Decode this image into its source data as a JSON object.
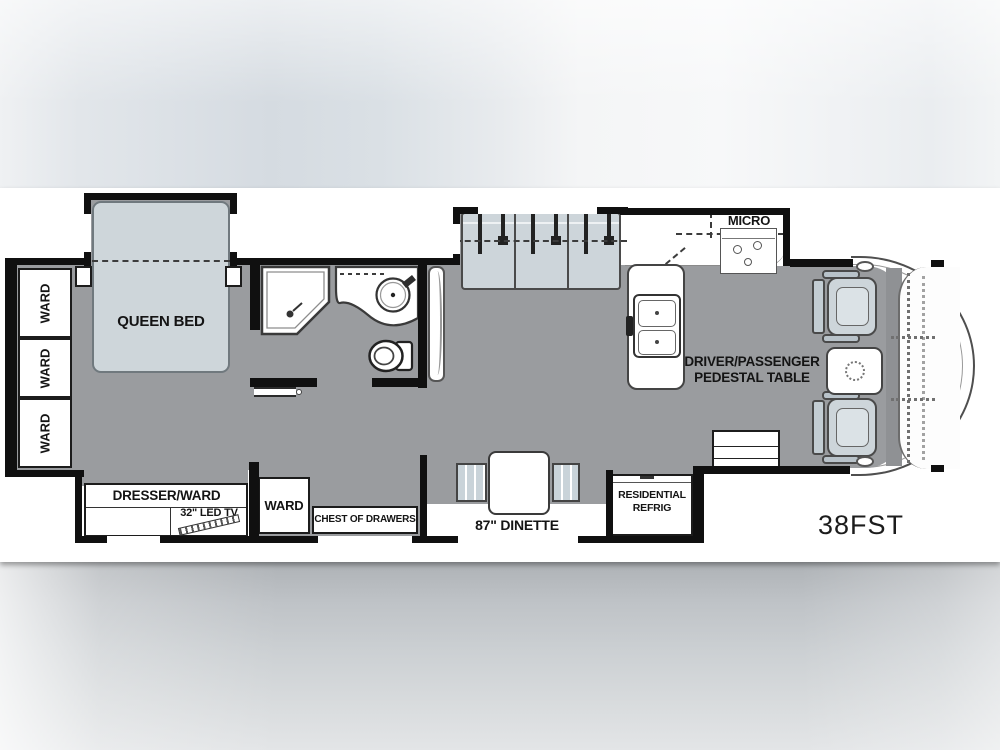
{
  "model_label": "38FST",
  "bedroom": {
    "queen_bed_label": "QUEEN BED",
    "wardrobes": [
      "WARD",
      "WARD",
      "WARD"
    ],
    "dresser_ward_label": "DRESSER/WARD",
    "tv_label": "32\" LED TV",
    "ward_label": "WARD",
    "chest_label": "CHEST OF DRAWERS"
  },
  "kitchen": {
    "micro_label": "MICRO",
    "dinette_label": "87\" DINETTE",
    "refrig_line1": "RESIDENTIAL",
    "refrig_line2": "REFRIG"
  },
  "cab": {
    "pedestal_line1": "DRIVER/PASSENGER",
    "pedestal_line2": "PEDESTAL TABLE"
  },
  "colors": {
    "wall": "#101010",
    "floor": "#9a9c9f",
    "furniture": "#cdd5da",
    "paper": "#ffffff"
  }
}
